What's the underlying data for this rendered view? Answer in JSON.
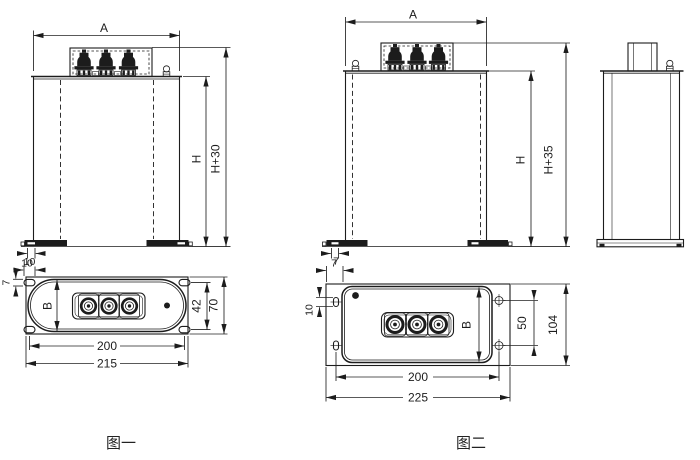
{
  "drawing": {
    "background": "#ffffff",
    "line_color": "#1c1c1c"
  },
  "figure1": {
    "caption": "图一",
    "front_view": {
      "width_dim": "A",
      "body_height_dim": "H",
      "overall_height_dim": "H+30",
      "foot_slot_dim": "10"
    },
    "bottom_view": {
      "corner_slot_width_dim": "10",
      "corner_slot_height_dim": "7",
      "body_depth_dim": "B",
      "hole_row_spacing_dim": "42",
      "plate_depth_dim": "70",
      "hole_pitch_dim": "200",
      "plate_width_dim": "215"
    }
  },
  "figure2": {
    "caption": "图二",
    "front_view": {
      "width_dim": "A",
      "body_height_dim": "H",
      "overall_height_dim": "H+35",
      "foot_slot_dim": "7"
    },
    "bottom_view": {
      "ear_width_dim": "7",
      "slot_length_dim": "10",
      "body_depth_dim": "B",
      "hole_row_spacing_dim": "50",
      "frame_depth_dim": "104",
      "hole_pitch_dim": "200",
      "frame_width_dim": "225"
    }
  }
}
